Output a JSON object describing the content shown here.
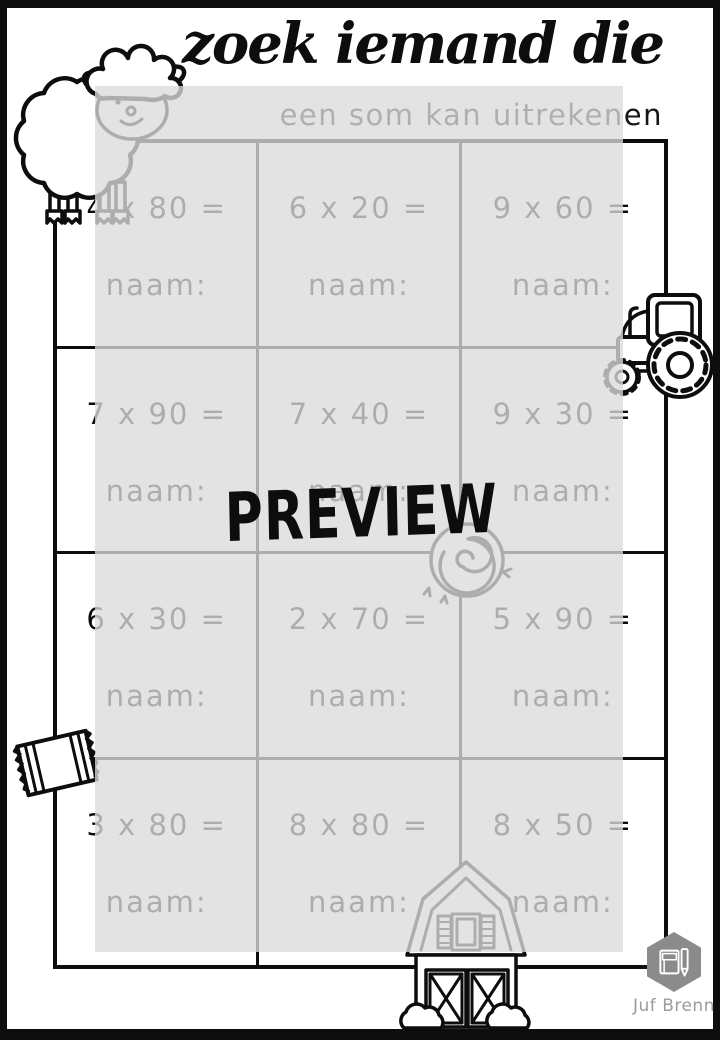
{
  "header": {
    "title": "zoek iemand die",
    "subtitle": "een som kan uitrekenen"
  },
  "watermark": "PREVIEW",
  "worksheet": {
    "name_label": "naam:",
    "problems": [
      "4 x 80 =",
      "6 x 20 =",
      "9 x 60 =",
      "7 x 90 =",
      "7 x 40 =",
      "9 x 30 =",
      "6 x 30 =",
      "2 x 70 =",
      "5 x 90 =",
      "3 x 80 =",
      "8 x 80 =",
      "8 x 50 ="
    ]
  },
  "brand": {
    "name": "Juf Brenn",
    "logo_icon": "book-and-pencil-icon"
  },
  "illustrations": {
    "top_left": "sheep-illustration",
    "right": "tractor-illustration",
    "left": "hay-bale-illustration",
    "center": "hay-roll-illustration",
    "bottom": "barn-illustration"
  },
  "colors": {
    "ink": "#0d0d0d",
    "muted_gray": "#ababab",
    "overlay_gray": "#dbdbdb",
    "brand_gray": "#8b8b8b",
    "page_background": "#ffffff"
  }
}
